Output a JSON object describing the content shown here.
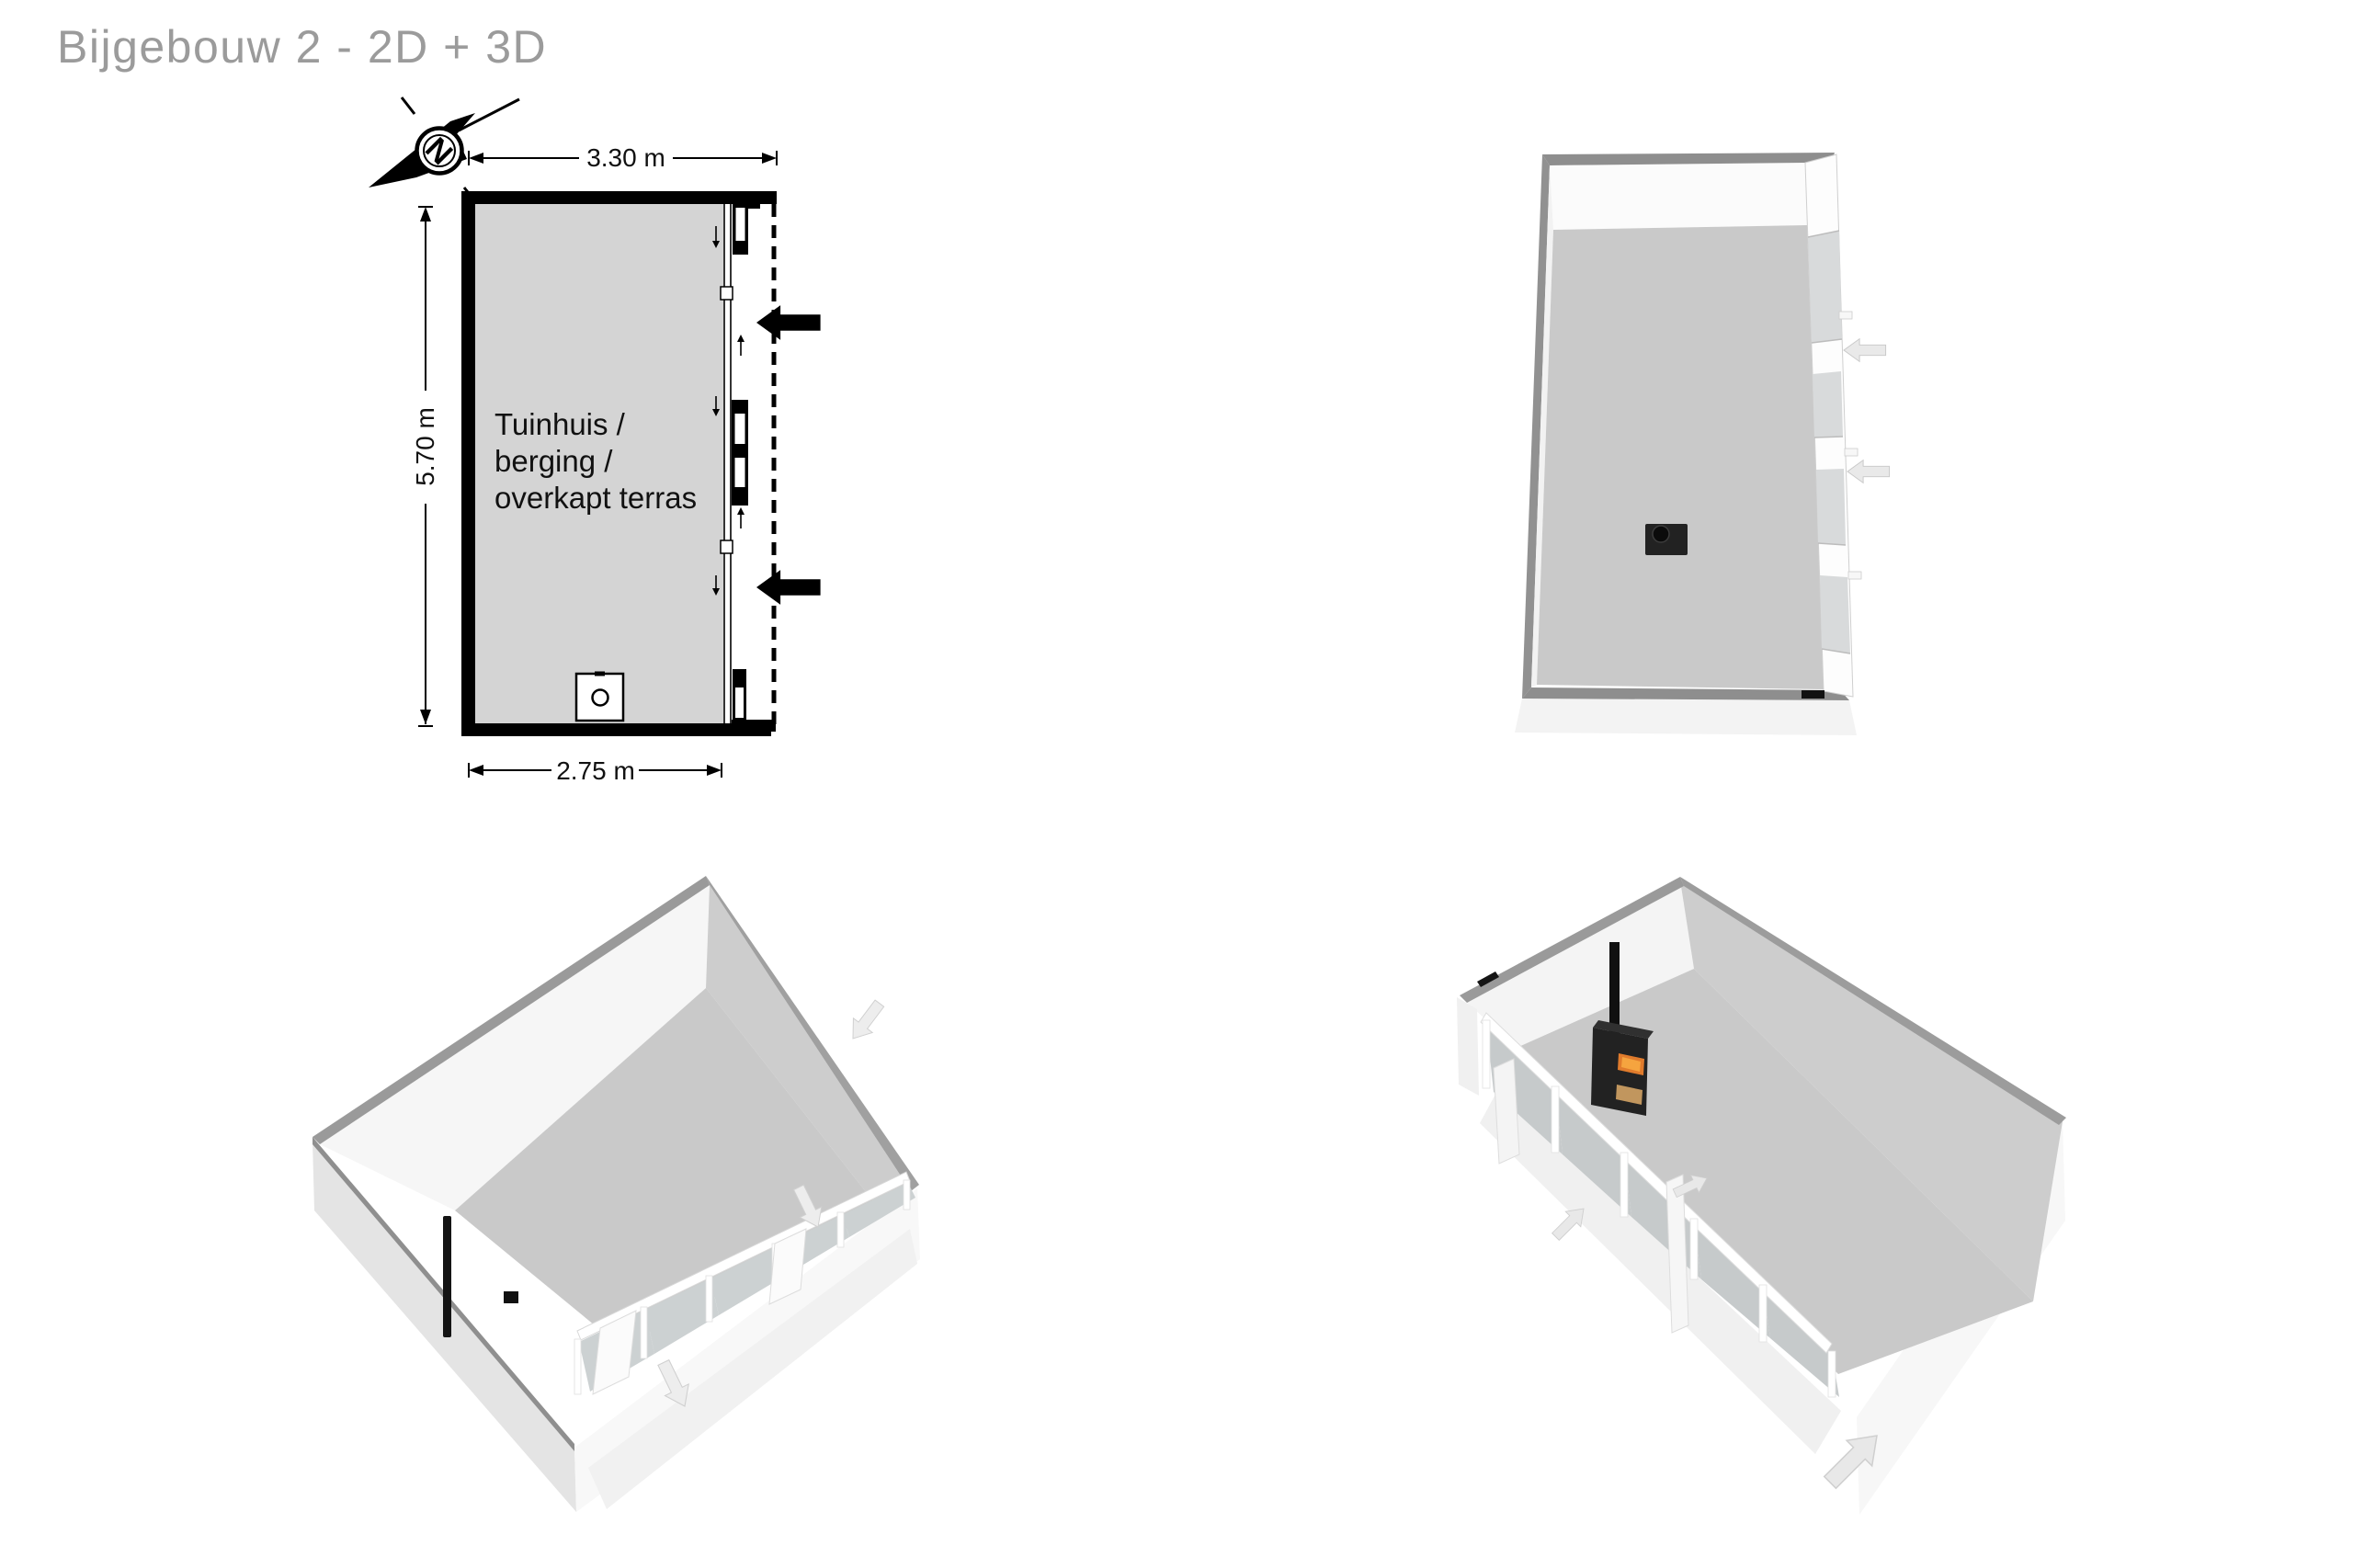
{
  "title": "Bijgebouw 2 - 2D + 3D",
  "plan2d": {
    "room_label": {
      "line1": "Tuinhuis /",
      "line2": "berging /",
      "line3": "overkapt terras"
    },
    "dimensions": {
      "top": "3.30 m",
      "left": "5.70 m",
      "bottom": "2.75 m"
    },
    "compass": {
      "letter": "N"
    }
  },
  "colors": {
    "title_text": "#9b9b9b",
    "plan_wall": "#000000",
    "plan_room_fill": "#d4d4d4",
    "label_text": "#111111",
    "wall_top_gray": "#8e8e8e",
    "floor_gray": "#c9c9c9",
    "inner_wall_gray": "#cdcdcd",
    "outer_wall_gray": "#e4e4e4",
    "glass_pane_gray": "#cbd0d1",
    "arrow_3d_fill": "#e9e9e9",
    "stove_body": "#222222",
    "stove_fire": "#e07b2c",
    "stove_wood": "#c1965e"
  }
}
